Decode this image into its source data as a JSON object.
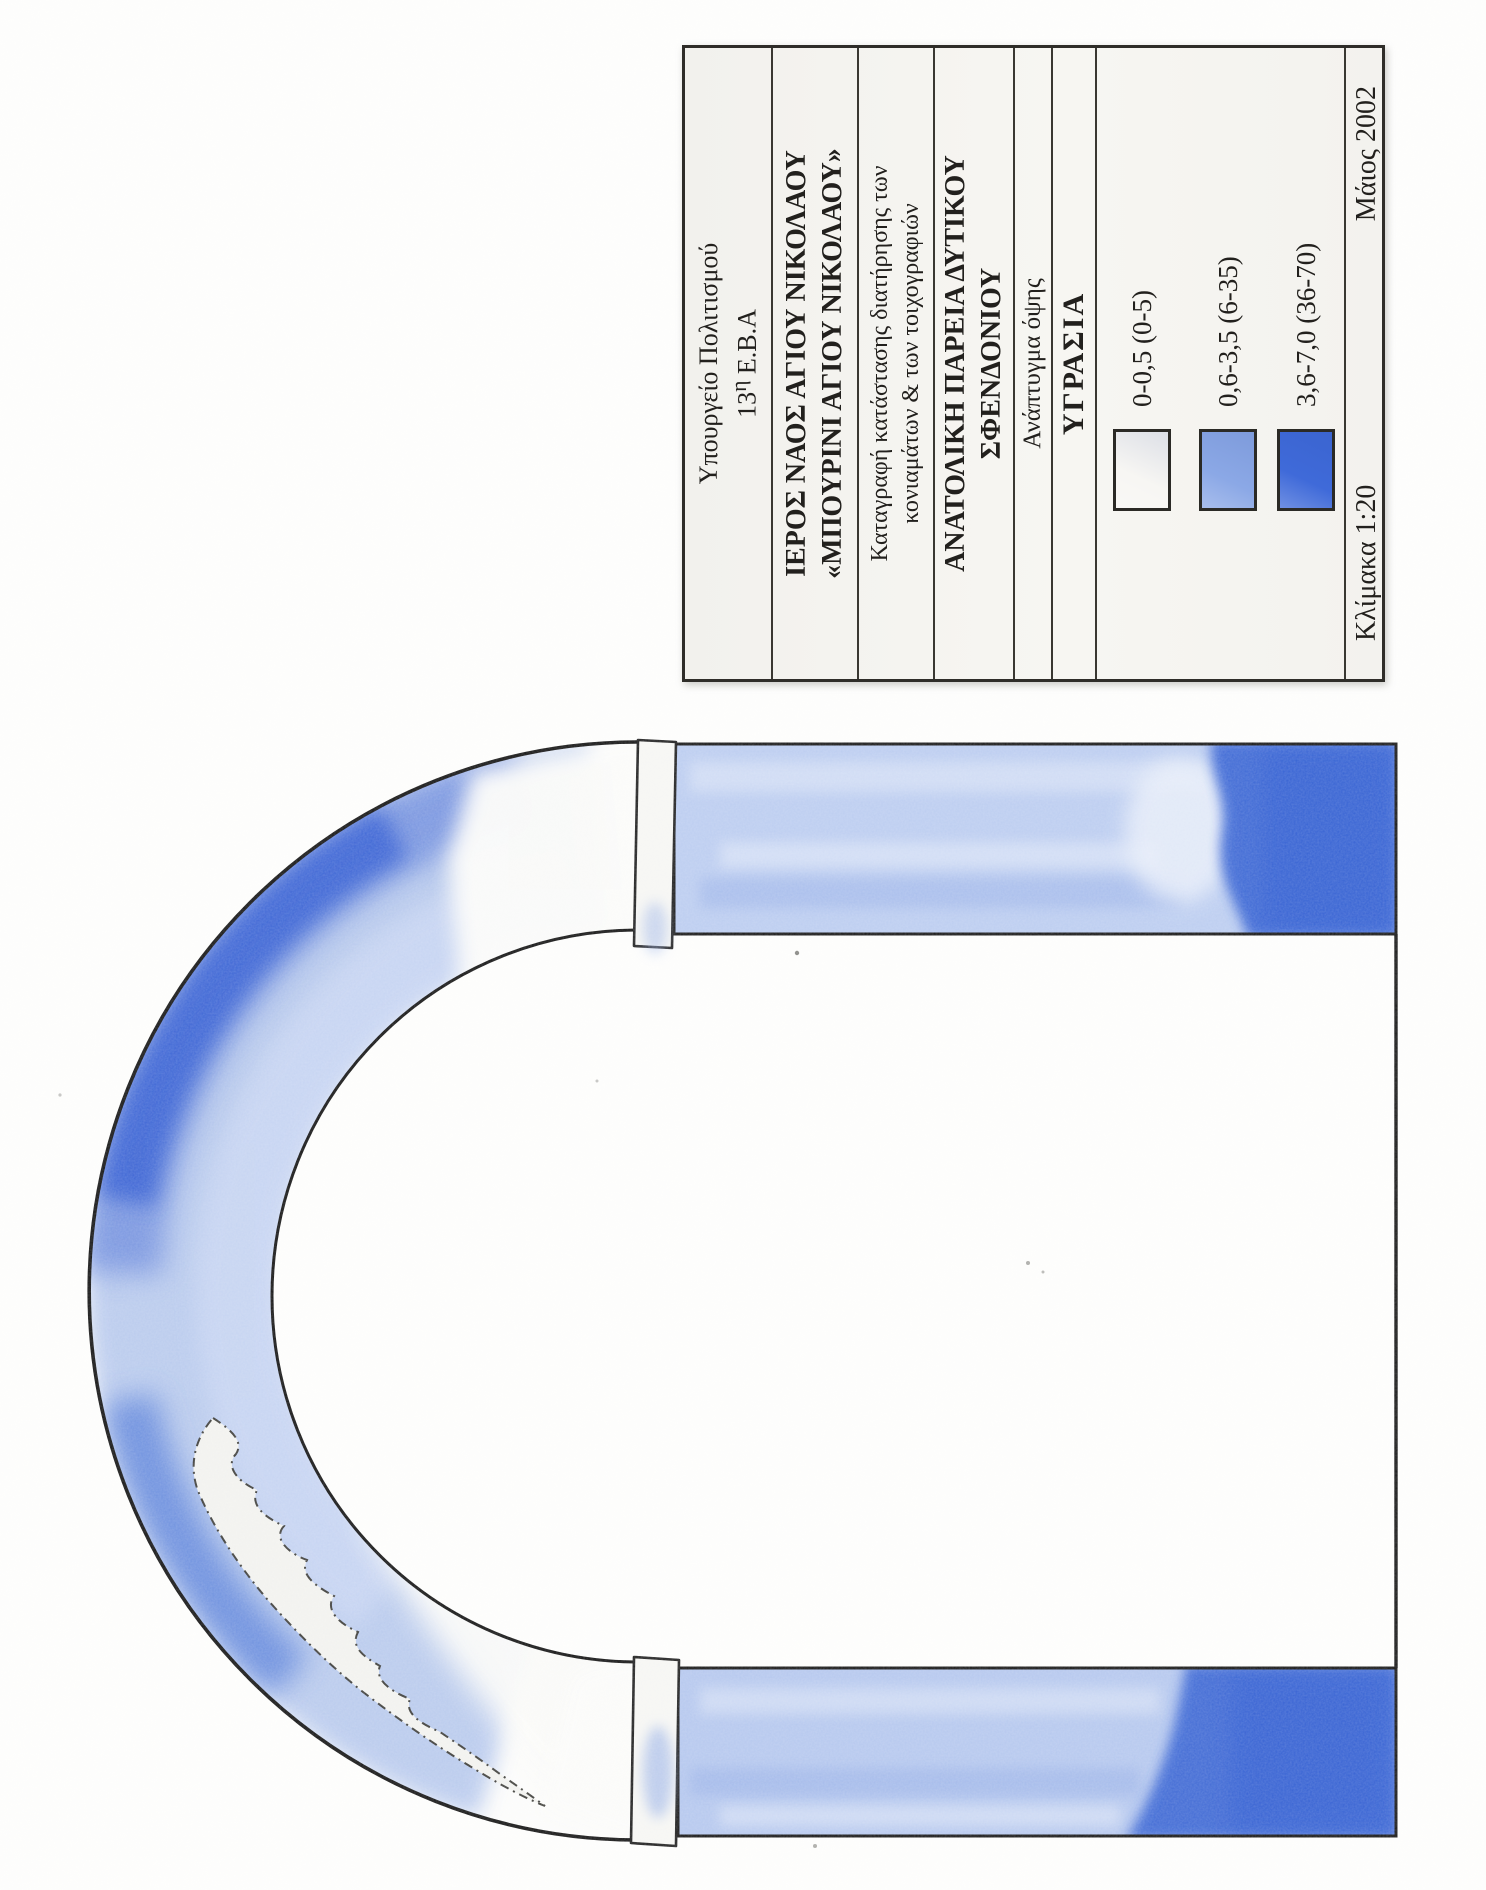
{
  "document": {
    "kind": "scanned conservation drawing, sheet rotated 90 degrees counter-clockwise",
    "language": "Greek"
  },
  "title_block": {
    "org_line1": "Υπουργείο Πολιτισμού",
    "org_line2_num": "13",
    "org_line2_sup": "η",
    "org_line2_rest": " Ε.Β.Α",
    "church_line1": "ΙΕΡΟΣ ΝΑΟΣ ΑΓΙΟΥ ΝΙΚΟΛΑΟΥ",
    "church_line2": "«ΜΠΟΥΡΙΝΙ ΑΓΙΟΥ ΝΙΚΟΛΑΟΥ»",
    "subject_line1": "Καταγραφή κατάστασης διατήρησης των",
    "subject_line2": "κονιαμάτων & των τοιχογραφιών",
    "location_line1": "ΑΝΑΤΟΛΙΚΗ ΠΑΡΕΙΑ ΔΥΤΙΚΟΥ",
    "location_line2": "ΣΦΕΝΔΟΝΙΟΥ",
    "view_type": "Ανάπτυγμα όψης",
    "map_theme": "ΥΓΡΑΣΙΑ",
    "scale_label": "Κλίμακα 1:20",
    "date_label": "Μάιος 2002"
  },
  "legend": {
    "entries": [
      {
        "label": "0-0,5 (0-5)",
        "color": "#f7f6f3"
      },
      {
        "label": "0,6-3,5 (6-35)",
        "color": "#8ba8e6"
      },
      {
        "label": "3,6-7,0 (36-70)",
        "color": "#3f6ad9"
      }
    ]
  },
  "artwork_colors": {
    "pencil_light": "#b5c7ec",
    "pencil_medium": "#7693df",
    "pencil_dark": "#3b64d4",
    "outline_ink": "#181818",
    "paper": "#fdfdfc"
  }
}
